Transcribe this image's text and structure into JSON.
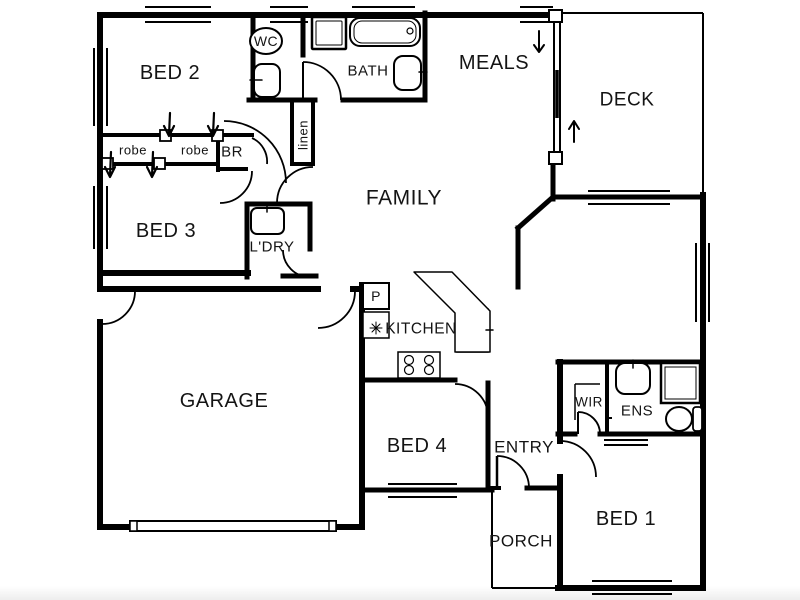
{
  "page": {
    "background": "#ffffff",
    "ink": "#000000",
    "type_note": "residential floor plan drawing"
  },
  "floorplan": {
    "canvas": {
      "width": 800,
      "height": 600
    },
    "rooms": [
      {
        "id": "bed-2",
        "label": "BED 2",
        "x": 170,
        "y": 73,
        "size": 20
      },
      {
        "id": "bed-3",
        "label": "BED 3",
        "x": 166,
        "y": 231,
        "size": 20
      },
      {
        "id": "family",
        "label": "FAMILY",
        "x": 404,
        "y": 198,
        "size": 21
      },
      {
        "id": "meals",
        "label": "MEALS",
        "x": 494,
        "y": 63,
        "size": 20
      },
      {
        "id": "deck",
        "label": "DECK",
        "x": 627,
        "y": 100,
        "size": 19
      },
      {
        "id": "garage",
        "label": "GARAGE",
        "x": 224,
        "y": 401,
        "size": 20
      },
      {
        "id": "bed-4",
        "label": "BED 4",
        "x": 417,
        "y": 446,
        "size": 20
      },
      {
        "id": "entry",
        "label": "ENTRY",
        "x": 524,
        "y": 447,
        "size": 17
      },
      {
        "id": "porch",
        "label": "PORCH",
        "x": 521,
        "y": 541,
        "size": 17
      },
      {
        "id": "bed-1",
        "label": "BED 1",
        "x": 626,
        "y": 519,
        "size": 20
      },
      {
        "id": "kitchen",
        "label": "KITCHEN",
        "x": 421,
        "y": 329,
        "size": 15.5
      },
      {
        "id": "bath",
        "label": "BATH",
        "x": 368,
        "y": 71,
        "size": 15
      },
      {
        "id": "wc",
        "label": "WC",
        "x": 266,
        "y": 41,
        "size": 14
      },
      {
        "id": "ldry",
        "label": "L'DRY",
        "x": 272,
        "y": 247,
        "size": 15
      },
      {
        "id": "ens",
        "label": "ENS",
        "x": 637,
        "y": 411,
        "size": 15
      },
      {
        "id": "wir",
        "label": "WIR",
        "x": 589,
        "y": 402,
        "size": 13.5
      },
      {
        "id": "br",
        "label": "BR",
        "x": 232,
        "y": 152,
        "size": 15
      },
      {
        "id": "robe-1",
        "label": "robe",
        "x": 133,
        "y": 150,
        "size": 13
      },
      {
        "id": "robe-2",
        "label": "robe",
        "x": 195,
        "y": 150,
        "size": 13
      },
      {
        "id": "linen",
        "label": "linen",
        "x": 303,
        "y": 135,
        "size": 13,
        "rotate": -90
      },
      {
        "id": "pantry",
        "label": "P",
        "x": 376,
        "y": 296,
        "size": 14
      }
    ],
    "walls": [
      [
        100,
        15,
        553,
        15,
        6,
        "top-exterior-wall"
      ],
      [
        100,
        15,
        100,
        289,
        6,
        "left-exterior-wall-upper"
      ],
      [
        100,
        322,
        100,
        527,
        6,
        "left-exterior-wall-lower"
      ],
      [
        100,
        527,
        362,
        527,
        6,
        "garage-front-wall"
      ],
      [
        362,
        285,
        362,
        527,
        6,
        "garage-kitchen-west-wall"
      ],
      [
        362,
        490,
        492,
        490,
        5,
        "bed4-front-wall"
      ],
      [
        490,
        488,
        499,
        488,
        4,
        "porch-wall-left-stub"
      ],
      [
        527,
        488,
        560,
        488,
        5,
        "porch-wall-right-stub"
      ],
      [
        560,
        434,
        560,
        441,
        6,
        "bed1-left-wall-upper"
      ],
      [
        560,
        477,
        560,
        588,
        6,
        "bed1-left-wall"
      ],
      [
        558,
        588,
        703,
        588,
        6,
        "bed1-rear-wall"
      ],
      [
        703,
        195,
        703,
        588,
        6,
        "right-exterior-wall"
      ],
      [
        553,
        197,
        703,
        197,
        5,
        "family-deck-wall"
      ],
      [
        553,
        164,
        553,
        199,
        5,
        "meals-wall-below-slider"
      ],
      [
        553,
        197,
        518,
        228,
        5,
        "family-angled-wall"
      ],
      [
        518,
        228,
        518,
        287,
        5,
        "family-east-wall"
      ],
      [
        253,
        15,
        253,
        100,
        5,
        "bed2-wc-wall"
      ],
      [
        249,
        100,
        315,
        100,
        5,
        "wc-south-wall"
      ],
      [
        343,
        100,
        425,
        100,
        5,
        "bath-south-wall"
      ],
      [
        425,
        13,
        425,
        100,
        5,
        "bath-east-wall"
      ],
      [
        303,
        15,
        303,
        55,
        5,
        "wc-bath-wall"
      ],
      [
        292,
        103,
        292,
        164,
        4,
        "linen-west-wall"
      ],
      [
        313,
        103,
        313,
        164,
        4,
        "linen-east-wall"
      ],
      [
        292,
        164,
        313,
        164,
        4,
        "linen-south-wall"
      ],
      [
        100,
        135,
        252,
        135,
        4,
        "robe-north-wall"
      ],
      [
        100,
        164,
        218,
        164,
        4,
        "robe-south-wall"
      ],
      [
        218,
        134,
        218,
        170,
        4,
        "br-west-wall"
      ],
      [
        218,
        169,
        246,
        169,
        4,
        "br-south-wall"
      ],
      [
        100,
        273,
        248,
        273,
        6,
        "bed3-south-wall"
      ],
      [
        247,
        204,
        247,
        277,
        5,
        "ldry-west-wall"
      ],
      [
        248,
        204,
        310,
        204,
        5,
        "ldry-north-wall"
      ],
      [
        310,
        204,
        310,
        249,
        5,
        "ldry-east-wall"
      ],
      [
        283,
        276,
        316,
        276,
        5,
        "ldry-south-wall"
      ],
      [
        103,
        289,
        318,
        289,
        6,
        "garage-north-wall"
      ],
      [
        353,
        289,
        362,
        289,
        6,
        "garage-north-wall-stub"
      ],
      [
        362,
        380,
        455,
        380,
        5,
        "kitchen-bed4-wall"
      ],
      [
        488,
        383,
        488,
        490,
        5,
        "bed4-east-wall"
      ],
      [
        558,
        362,
        703,
        362,
        5,
        "wir-ens-north-wall"
      ],
      [
        560,
        362,
        560,
        434,
        6,
        "wir-west-wall"
      ],
      [
        607,
        362,
        607,
        434,
        4,
        "wir-ens-divider-wall"
      ],
      [
        558,
        434,
        575,
        434,
        5,
        "ens-south-wall-west"
      ],
      [
        600,
        434,
        703,
        434,
        5,
        "ens-south-wall-east"
      ]
    ],
    "window_lines": [
      [
        145,
        7,
        211,
        7
      ],
      [
        145,
        22,
        211,
        22
      ],
      [
        270,
        7,
        308,
        7
      ],
      [
        270,
        22,
        308,
        22
      ],
      [
        352,
        7,
        415,
        7
      ],
      [
        352,
        22,
        415,
        22
      ],
      [
        520,
        7,
        553,
        7
      ],
      [
        520,
        22,
        553,
        22
      ],
      [
        94,
        48,
        94,
        126
      ],
      [
        107,
        48,
        107,
        126
      ],
      [
        94,
        186,
        94,
        249
      ],
      [
        107,
        186,
        107,
        249
      ],
      [
        696,
        243,
        696,
        322
      ],
      [
        709,
        243,
        709,
        322
      ],
      [
        588,
        191,
        670,
        191
      ],
      [
        588,
        204,
        670,
        204
      ],
      [
        388,
        484,
        457,
        484
      ],
      [
        388,
        497,
        457,
        497
      ],
      [
        592,
        581,
        672,
        581
      ],
      [
        592,
        594,
        672,
        594
      ]
    ],
    "thin_lines": [
      [
        562,
        13,
        703,
        13,
        2,
        "deck-edge-top"
      ],
      [
        703,
        13,
        703,
        195,
        2,
        "deck-edge-right"
      ],
      [
        492,
        490,
        492,
        588,
        2,
        "porch-edge-left"
      ],
      [
        492,
        588,
        558,
        588,
        2,
        "porch-edge-bottom"
      ],
      [
        554,
        22,
        554,
        152,
        2,
        "slider-track-a"
      ],
      [
        560,
        22,
        560,
        152,
        2,
        "slider-track-b"
      ],
      [
        557,
        70,
        557,
        118,
        3.5,
        "slider-panel"
      ],
      [
        575,
        384,
        600,
        384,
        1.5,
        "wir-shelf-a"
      ],
      [
        575,
        384,
        575,
        420,
        1.5,
        "wir-shelf-b"
      ],
      [
        604,
        440,
        648,
        440,
        2,
        "ens-cavity-slider-a"
      ],
      [
        604,
        445,
        648,
        445,
        2,
        "ens-cavity-slider-b"
      ],
      [
        605,
        418,
        612,
        418,
        2,
        "ens-door-dash"
      ],
      [
        303,
        62,
        303,
        100,
        2,
        "bath-door-leaf"
      ],
      [
        497,
        456,
        497,
        488,
        2.5,
        "entry-door-leaf"
      ],
      [
        578,
        412,
        578,
        434,
        2,
        "wir-door-leaf"
      ],
      [
        138,
        526,
        328,
        526,
        1.5,
        "garage-door-rail"
      ]
    ],
    "door_arcs": [
      [
        "M303,62 A38,38 0 0 1 341,100",
        "bath-door-arc"
      ],
      [
        "M313,167 A36,36 0 0 0 277,203",
        "hall-door-arc"
      ],
      [
        "M224,121 A62,62 0 0 1 286,183",
        "family-hall-door-arc"
      ],
      [
        "M283,250 A27,27 0 0 0 310,277",
        "ldry-door-arc"
      ],
      [
        "M220,203 A32,32 0 0 0 252,171",
        "bed3-door-arc"
      ],
      [
        "M135,291 A33,33 0 0 1 102,324",
        "garage-side-door-arc"
      ],
      [
        "M355,291 A37,37 0 0 1 318,328",
        "garage-entry-door-arc"
      ],
      [
        "M455,384 A33,33 0 0 1 488,417",
        "bed4-door-arc"
      ],
      [
        "M497,456 A32,32 0 0 1 529,488",
        "entry-door-arc"
      ],
      [
        "M560,441 A36,36 0 0 1 596,477",
        "bed1-door-arc"
      ],
      [
        "M578,412 A22,22 0 0 1 600,434",
        "wir-door-arc"
      ],
      [
        "M252,138 A26,26 0 0 1 267,164",
        "br-door-arc"
      ]
    ],
    "rects": [
      [
        254,
        64,
        26,
        33,
        8,
        2,
        "wc-basin"
      ],
      [
        312,
        17,
        34,
        32,
        1,
        2.5,
        "bath-shower"
      ],
      [
        316,
        21,
        26,
        24,
        1,
        1,
        "bath-shower-inner"
      ],
      [
        350,
        18,
        70,
        28,
        10,
        2,
        "bathtub"
      ],
      [
        354,
        21,
        62,
        22,
        8,
        1,
        "bathtub-inner"
      ],
      [
        394,
        56,
        27,
        34,
        9,
        2,
        "bath-basin"
      ],
      [
        251,
        208,
        33,
        26,
        6,
        2,
        "laundry-trough"
      ],
      [
        363,
        283,
        26,
        26,
        0,
        2,
        "pantry-cupboard"
      ],
      [
        363,
        312,
        26,
        26,
        0,
        1.5,
        "fridge"
      ],
      [
        457,
        309,
        31,
        43,
        0,
        1.5,
        "kitchen-sink"
      ],
      [
        462,
        317,
        21,
        27,
        6,
        1.2,
        "kitchen-sink-bowl"
      ],
      [
        398,
        352,
        42,
        26,
        0,
        1.5,
        "cooktop"
      ],
      [
        616,
        363,
        34,
        31,
        9,
        2,
        "ens-basin"
      ],
      [
        661,
        363,
        39,
        40,
        0,
        2.5,
        "ens-shower"
      ],
      [
        665,
        367,
        31,
        32,
        0,
        1,
        "ens-shower-inner"
      ],
      [
        693,
        407,
        9,
        24,
        3,
        1.8,
        "ens-cistern"
      ],
      [
        160,
        130,
        11,
        11,
        0,
        1.8,
        "robe-track-post-a"
      ],
      [
        212,
        130,
        11,
        11,
        0,
        1.8,
        "robe-track-post-b"
      ],
      [
        102,
        158,
        11,
        11,
        0,
        1.8,
        "robe-track-post-c"
      ],
      [
        154,
        158,
        11,
        11,
        0,
        1.8,
        "robe-track-post-d"
      ],
      [
        549,
        10,
        13,
        12,
        0,
        2,
        "slider-jamb-top"
      ],
      [
        549,
        152,
        13,
        12,
        0,
        2,
        "slider-jamb-bottom"
      ],
      [
        130,
        521,
        206,
        10,
        0,
        2,
        "garage-door-panel"
      ],
      [
        130,
        521,
        7,
        10,
        0,
        1.5,
        "garage-door-cap-left"
      ],
      [
        329,
        521,
        7,
        10,
        0,
        1.5,
        "garage-door-cap-right"
      ]
    ],
    "ellipses": [
      [
        266,
        41,
        16,
        13,
        2,
        "wc-toilet"
      ],
      [
        679,
        419,
        13,
        12,
        2,
        "ens-toilet"
      ],
      [
        409,
        360,
        4.5,
        4.5,
        1.2,
        "cooktop-burner"
      ],
      [
        429,
        360,
        4.5,
        4.5,
        1.2,
        "cooktop-burner"
      ],
      [
        409,
        370,
        4.5,
        4.5,
        1.2,
        "cooktop-burner"
      ],
      [
        429,
        370,
        4.5,
        4.5,
        1.2,
        "cooktop-burner"
      ],
      [
        410,
        31,
        3,
        3,
        1.2,
        "bath-drain"
      ]
    ],
    "paths": [
      [
        "M414,272 L452,272 L490,311 L490,352 L455,352 L455,313 Z",
        1.5,
        "#ffffff",
        "kitchen-bench"
      ],
      [
        "M539,31 L539,51 M534,45 L539,52 L544,45",
        2,
        "none",
        "meals-step-arrow-down"
      ],
      [
        "M574,142 L574,122 M569,129 L574,121 L579,129",
        2,
        "none",
        "deck-step-arrow-up"
      ],
      [
        "M170,113 L169,135 M164,126 L169,136 L174,126",
        2.2,
        "none",
        "robe-door-arrow-a"
      ],
      [
        "M214,113 L213,135 M208,126 L213,136 L218,126",
        2.2,
        "none",
        "robe-door-arrow-b"
      ],
      [
        "M111,152 L110,176 M105,167 L110,177 L115,167",
        2.2,
        "none",
        "robe-door-arrow-c"
      ],
      [
        "M153,152 L152,176 M147,167 L152,177 L157,167",
        2.2,
        "none",
        "robe-door-arrow-d"
      ],
      [
        "M262,80 L250,80",
        1.5,
        "none",
        "wc-basin-tap"
      ],
      [
        "M419,72 L427,72",
        1.5,
        "none",
        "bath-basin-tap"
      ],
      [
        "M267,203 L267,212 M262,204 L272,204",
        1.5,
        "none",
        "laundry-tap"
      ],
      [
        "M633,360 L633,368 M628,362 L638,362",
        1.5,
        "none",
        "ens-tap"
      ],
      [
        "M486,330 L493,330",
        1.5,
        "none",
        "kitchen-tap"
      ],
      [
        "M376,322 L376,334 M370,328 L382,328 M372,324 L380,332 M380,324 L372,332",
        1,
        "none",
        "fridge-snowflake"
      ]
    ]
  }
}
